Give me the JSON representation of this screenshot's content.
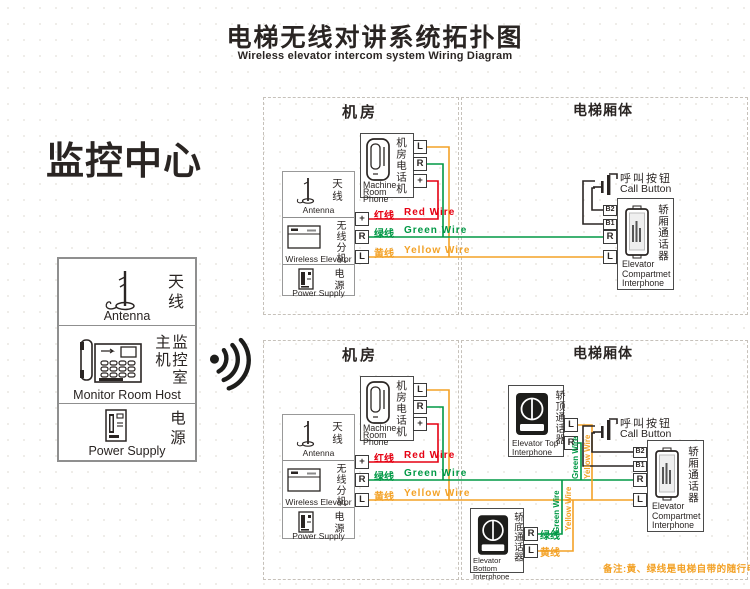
{
  "title": {
    "zh": "电梯无线对讲系统拓扑图",
    "en": "Wireless elevator intercom system Wiring Diagram"
  },
  "monitor_center": {
    "heading": "监控中心",
    "host_zh": "监控室主机",
    "host_en": "Monitor Room Host"
  },
  "shared": {
    "antenna_zh": "天线",
    "antenna_en": "Antenna",
    "power_zh": "电源",
    "power_en": "Power Supply"
  },
  "sections": {
    "machine_room": "机房",
    "elevator_body": "电梯厢体"
  },
  "devices": {
    "machine_room_phone": {
      "zh": "机房电话机",
      "en_line1": "Machine",
      "en_line2": "Room Phone",
      "terminals": [
        "L",
        "R",
        "+"
      ]
    },
    "wireless_extension": {
      "zh": "无线分机",
      "en": "Wireless Elevator",
      "terminals": [
        "+",
        "R",
        "L"
      ]
    },
    "call_button": {
      "zh": "呼叫按钮",
      "en": "Call Button"
    },
    "compartment_interphone": {
      "zh": "轿厢通话器",
      "en_line1": "Elevator",
      "en_line2": "Compartmet",
      "en_line3": "Interphone",
      "terminals": [
        "B2",
        "B1",
        "R",
        "L"
      ]
    },
    "top_interphone": {
      "zh": "轿顶通话器",
      "en_line1": "Elevator Top",
      "en_line2": "Interphone",
      "terminals": [
        "L",
        "R"
      ]
    },
    "bottom_interphone": {
      "zh": "轿底通话器",
      "en_line1": "Elevator Bottom",
      "en_line2": "Interphone",
      "terminals": [
        "R",
        "L"
      ],
      "r_wire_zh": "绿线",
      "l_wire_zh": "黄线"
    }
  },
  "wires": {
    "red_zh": "红线",
    "red_en": "Red Wire",
    "green_zh": "绿线",
    "green_en": "Green Wire",
    "yellow_zh": "黄线",
    "yellow_en": "Yellow Wire"
  },
  "note": "备注:黄、绿线是电梯自带的随行电缆",
  "colors": {
    "red": "#e50012",
    "green": "#009845",
    "yellow": "#f3a227",
    "ink": "#2a2523",
    "border": "#8f8f8f"
  }
}
